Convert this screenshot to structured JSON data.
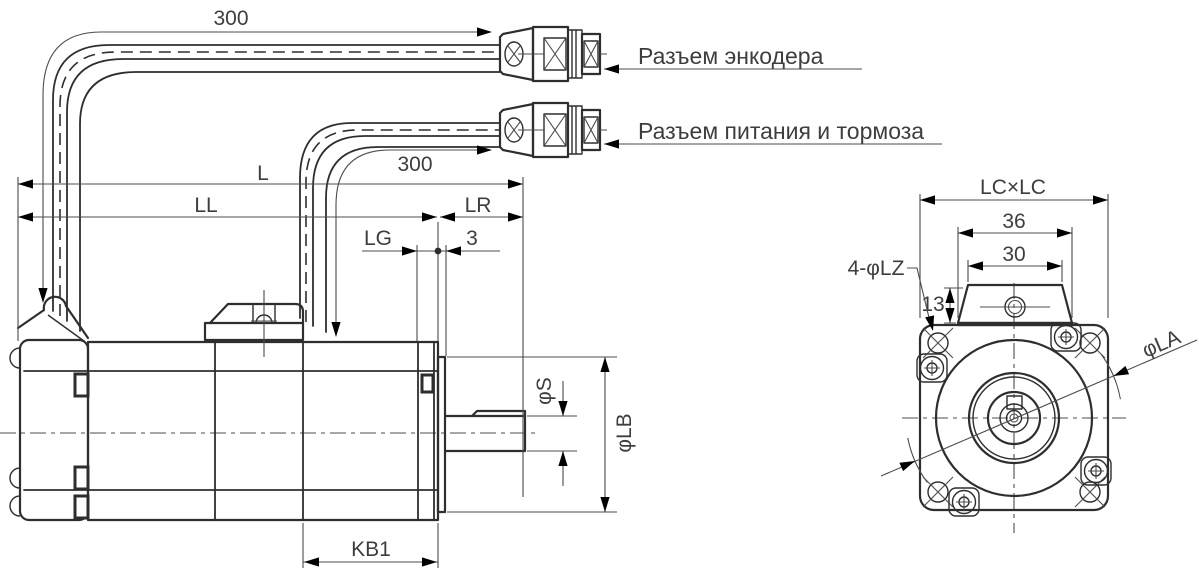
{
  "side_view": {
    "cable_encoder_length": "300",
    "cable_power_length": "300",
    "dim_total_length": "L",
    "dim_body_length": "LL",
    "dim_shaft_ext": "LR",
    "dim_flange_thickness": "LG",
    "dim_spigot_depth": "3",
    "dim_shaft_diameter": "φS",
    "dim_spigot_diameter": "φLB",
    "dim_kb1": "KB1",
    "label_encoder_connector": "Разъем энкодера",
    "label_power_brake_connector": "Разъем питания и тормоза"
  },
  "front_view": {
    "dim_flange_size": "LC×LC",
    "dim_box_base_width": "36",
    "dim_box_top_width": "30",
    "dim_box_height": "13",
    "dim_mounting_holes": "4-φLZ",
    "dim_bolt_circle": "φLA"
  },
  "colors": {
    "line": "#2e2e2e",
    "thin": "#4c4c4c",
    "text": "#3d3d3d",
    "background": "#ffffff"
  }
}
